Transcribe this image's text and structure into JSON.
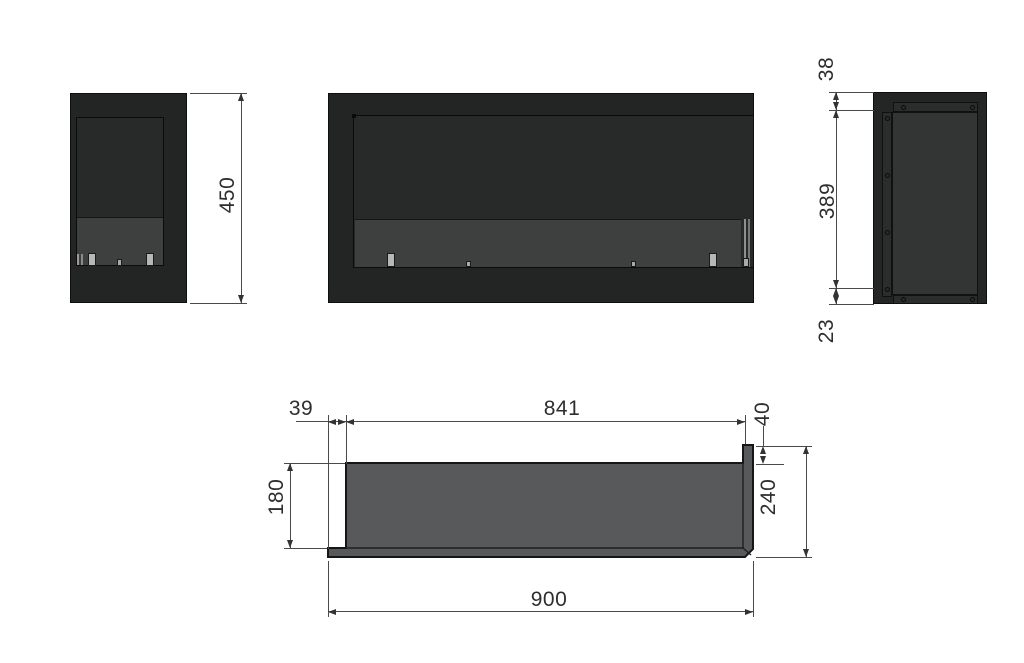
{
  "drawing": {
    "type": "technical-orthographic-drawing",
    "part": "built-in bio fireplace corner insert",
    "units_shown": "none (millimeter values)",
    "dimensions": {
      "left_view": {
        "height": "450"
      },
      "right_view": {
        "top_offset": "38",
        "opening_height": "389",
        "bottom_offset": "23"
      },
      "plan_view": {
        "left_offset": "39",
        "opening_width": "841",
        "flange_depth": "40",
        "wall_depth": "180",
        "total_depth": "240",
        "total_width": "900"
      }
    },
    "colors": {
      "background": "#ffffff",
      "body_black": "#232424",
      "opening_black": "#282929",
      "burner_band_gray": "#3e3f3f",
      "side_panel_gray": "#333434",
      "plan_section_gray": "#58595a",
      "dimension_line": "#4a4a4a",
      "dimension_text": "#2e2e2e",
      "tab_light_gray": "#b7b7b7"
    }
  }
}
